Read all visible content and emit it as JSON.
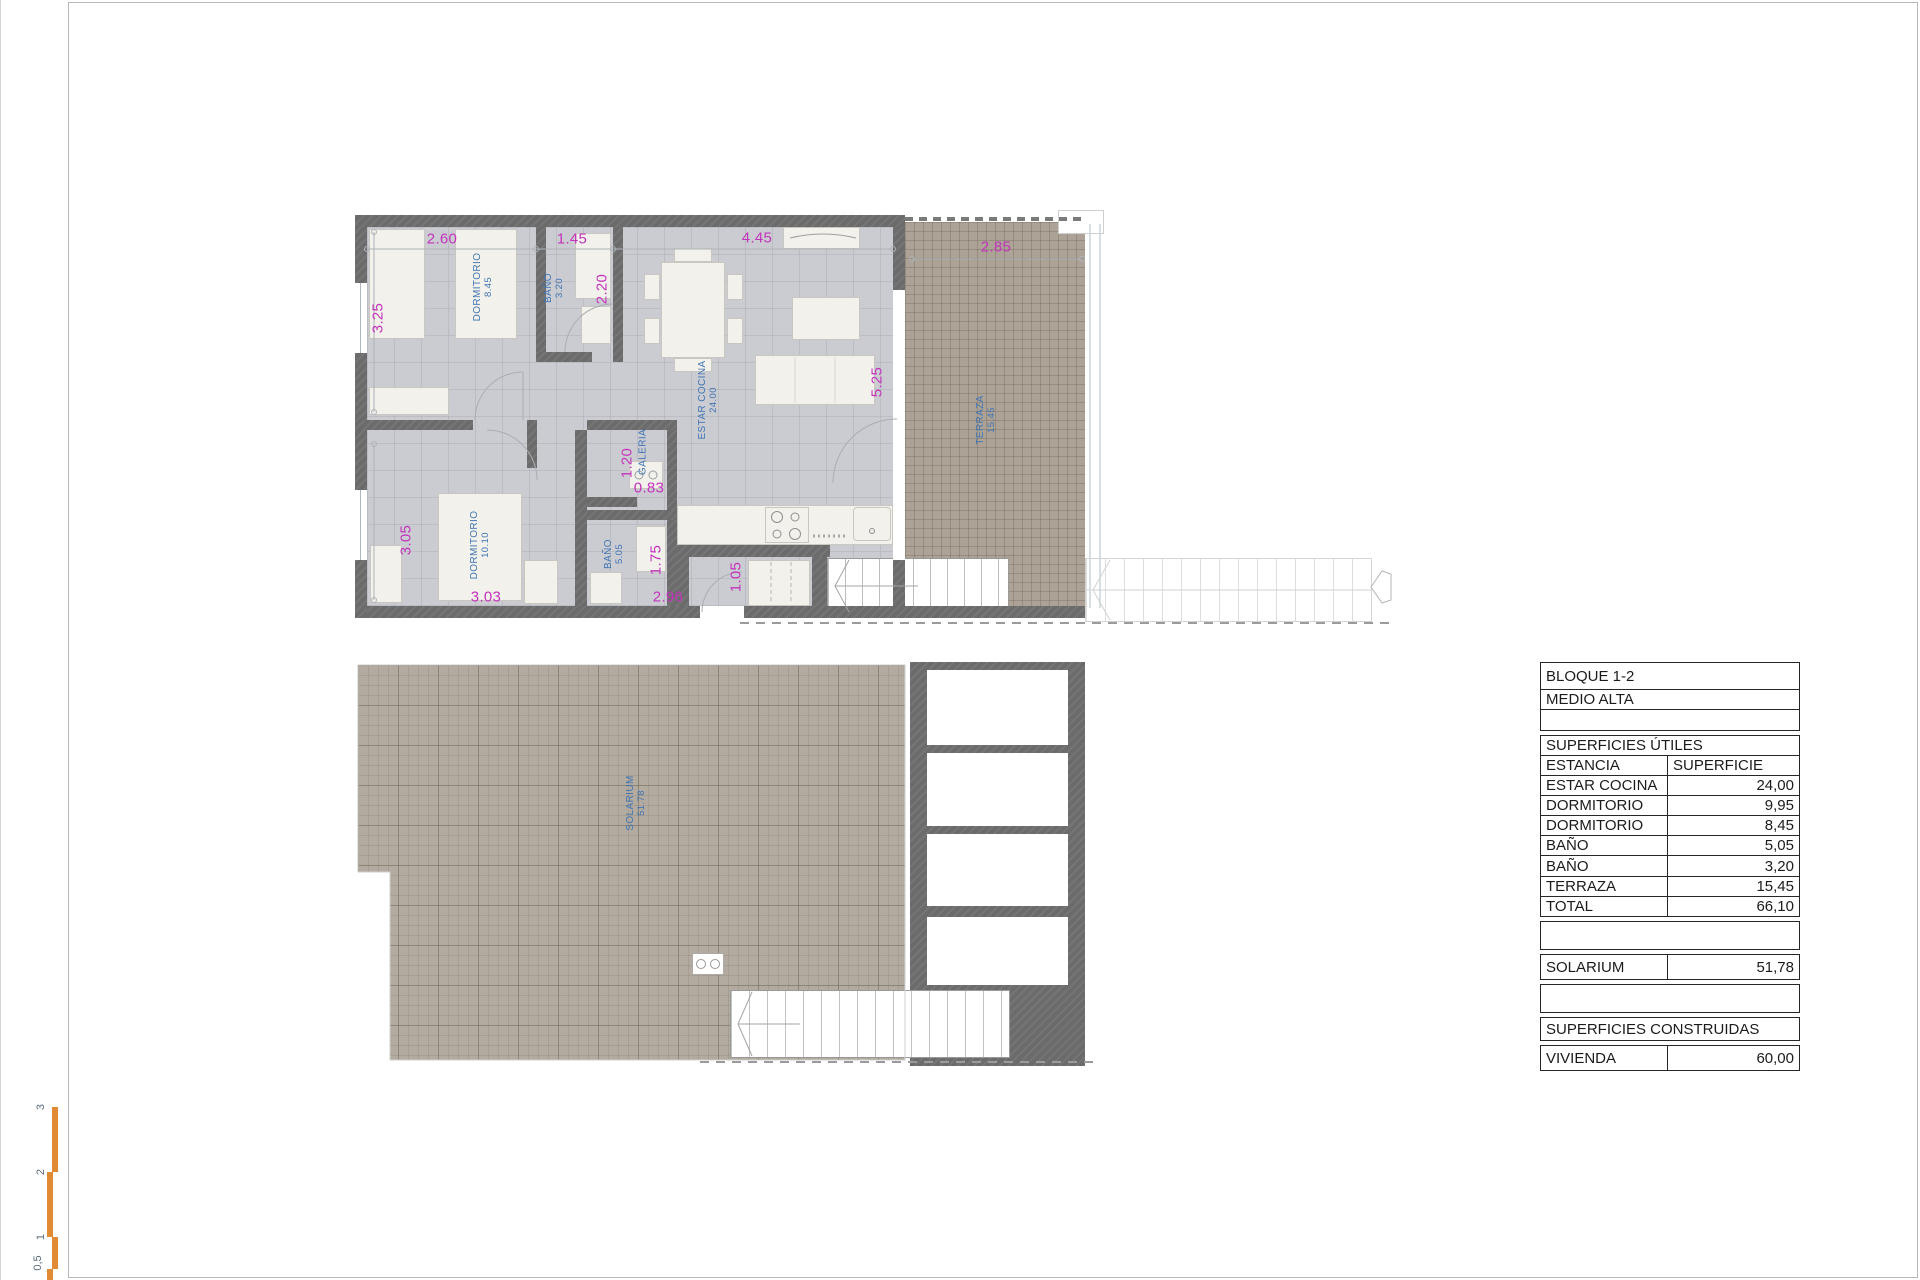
{
  "plan": {
    "dims": {
      "d260": "2.60",
      "d145": "1.45",
      "d445": "4.45",
      "d285": "2.85",
      "d325": "3.25",
      "d220": "2.20",
      "d525": "5.25",
      "d305": "3.05",
      "d120": "1.20",
      "d083": "0.83",
      "d175": "1.75",
      "d105": "1.05",
      "d303": "3.03",
      "d296": "2.96"
    },
    "rooms": {
      "dorm1": {
        "label": "DORMITORIO",
        "area": "8.45"
      },
      "bath1": {
        "label": "BAÑO",
        "area": "3.20"
      },
      "estar": {
        "label": "ESTAR COCINA",
        "area": "24.00"
      },
      "terraza": {
        "label": "TERRAZA",
        "area": "15.45"
      },
      "dorm2": {
        "label": "DORMITORIO",
        "area": "10.10"
      },
      "bath2": {
        "label": "BAÑO",
        "area": "5.05"
      },
      "galeria": {
        "label": "GALERIA"
      },
      "solarium": {
        "label": "SOLARIUM",
        "area": "51.78"
      }
    }
  },
  "scale": {
    "labels": [
      "3",
      "2",
      "1",
      "0,5"
    ]
  },
  "table": {
    "title1": "BLOQUE 1-2",
    "title2": "MEDIO ALTA",
    "section1": "SUPERFICIES ÚTILES",
    "col1": "ESTANCIA",
    "col2": "SUPERFICIE",
    "rows": [
      {
        "label": "ESTAR COCINA",
        "value": "24,00"
      },
      {
        "label": "DORMITORIO",
        "value": "9,95"
      },
      {
        "label": "DORMITORIO",
        "value": "8,45"
      },
      {
        "label": "BAÑO",
        "value": "5,05"
      },
      {
        "label": "BAÑO",
        "value": "3,20"
      },
      {
        "label": "TERRAZA",
        "value": "15,45"
      },
      {
        "label": "TOTAL",
        "value": "66,10"
      }
    ],
    "solarium": {
      "label": "SOLARIUM",
      "value": "51,78"
    },
    "section2": "SUPERFICIES CONSTRUIDAS",
    "vivienda": {
      "label": "VIVIENDA",
      "value": "60,00"
    }
  },
  "colors": {
    "dimension_text": "#c433bc",
    "room_label_text": "#3f74b4",
    "wall": "#6b6b6b",
    "floor": "#cbccd1",
    "terrace": "#aca295",
    "solarium": "#b3ab9f",
    "scale_bar": "#e08a33"
  }
}
